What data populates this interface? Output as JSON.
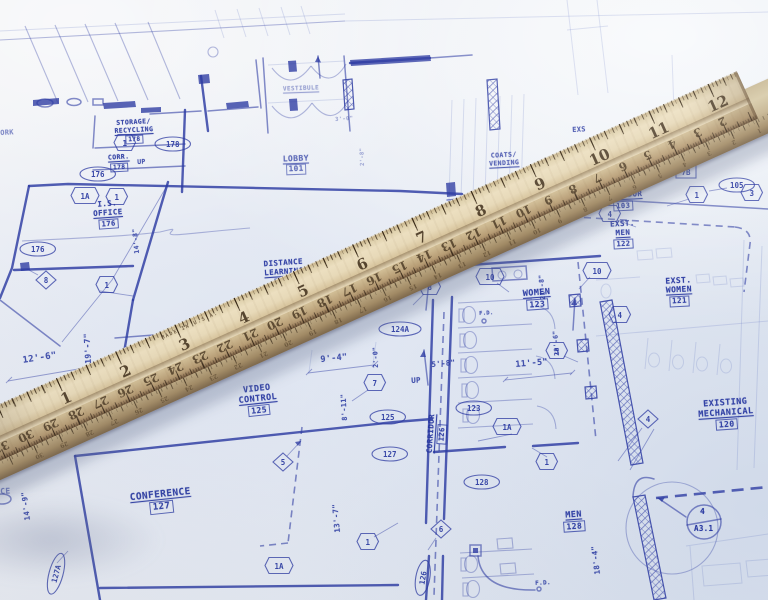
{
  "colors": {
    "ink": "#2c3aa2",
    "label_ink": "#2636a0",
    "paper": "#e9edf4",
    "wood_light": "#ecdfc0",
    "wood_dark": "#957858"
  },
  "ruler": {
    "made_in": "MADE IN U.S.A.",
    "inch_labels": [
      "1",
      "2",
      "3",
      "4",
      "5",
      "6",
      "7",
      "8",
      "9",
      "10",
      "11",
      "12"
    ],
    "cm_min": 1,
    "cm_max": 31,
    "ruler2_cm_min": 1,
    "ruler2_cm_max": 30
  },
  "blueprint": {
    "rooms": [
      {
        "lines": [
          "STORAGE/",
          "RECYCLING"
        ],
        "num": "178",
        "x": 103,
        "y": 119,
        "w": 62,
        "fs": 6.5,
        "rot": -3
      },
      {
        "lines": [
          "CORR."
        ],
        "num": "178",
        "x": 100,
        "y": 154,
        "w": 38,
        "fs": 6.5,
        "rot": -3
      },
      {
        "lines": [
          "I.S.",
          "OFFICE"
        ],
        "num": "176",
        "x": 82,
        "y": 200,
        "w": 52,
        "fs": 7.5,
        "rot": -4
      },
      {
        "lines": [
          "VESTIBULE"
        ],
        "num": "",
        "x": 270,
        "y": 85,
        "w": 62,
        "fs": 6,
        "rot": -2,
        "op": 0.42
      },
      {
        "lines": [
          "LOBBY"
        ],
        "num": "101",
        "x": 272,
        "y": 154,
        "w": 48,
        "fs": 8,
        "rot": -2,
        "op": 0.7
      },
      {
        "lines": [
          "DISTANCE",
          "LEARNING"
        ],
        "num": "124",
        "x": 247,
        "y": 259,
        "w": 74,
        "fs": 7.5,
        "rot": -4
      },
      {
        "lines": [
          "COATS/",
          "VENDING"
        ],
        "num": "",
        "x": 482,
        "y": 152,
        "w": 44,
        "fs": 6.5,
        "rot": -3,
        "op": 0.8
      },
      {
        "lines": [
          "VIDEO",
          "CONTROL"
        ],
        "num": "125",
        "x": 225,
        "y": 384,
        "w": 66,
        "fs": 8.5,
        "rot": -6
      },
      {
        "lines": [
          "CONFERENCE"
        ],
        "num": "127",
        "x": 112,
        "y": 489,
        "w": 98,
        "fs": 9.5,
        "rot": -6
      },
      {
        "lines": [
          "WOMEN"
        ],
        "num": "123",
        "x": 508,
        "y": 288,
        "w": 58,
        "fs": 8.5,
        "rot": -4
      },
      {
        "lines": [
          "MEN"
        ],
        "num": "128",
        "x": 550,
        "y": 510,
        "w": 48,
        "fs": 8.5,
        "rot": -4
      },
      {
        "lines": [
          "CORRIDOR"
        ],
        "num": "126",
        "x": 406,
        "y": 424,
        "w": 62,
        "fs": 7.5,
        "rot": -86
      },
      {
        "lines": [
          "CORRIDOR"
        ],
        "num": "103",
        "x": 592,
        "y": 191,
        "w": 62,
        "fs": 7.5,
        "rot": -3
      },
      {
        "lines": [
          "EXST.",
          "MEN"
        ],
        "num": "122",
        "x": 600,
        "y": 220,
        "w": 46,
        "fs": 7.5,
        "rot": -3
      },
      {
        "lines": [
          "EXST.",
          "WOMEN"
        ],
        "num": "121",
        "x": 648,
        "y": 276,
        "w": 62,
        "fs": 8,
        "rot": -3
      },
      {
        "lines": [
          "EXISTING",
          "MECHANICAL"
        ],
        "num": "120",
        "x": 684,
        "y": 398,
        "w": 84,
        "fs": 8.5,
        "rot": -4
      }
    ],
    "dims": [
      {
        "t": "12'-6\"",
        "x": 22,
        "y": 356,
        "rot": -9,
        "fs": 9
      },
      {
        "t": "19'-7\"",
        "x": 84,
        "y": 364,
        "rot": -93,
        "fs": 8
      },
      {
        "t": "14'-8\"",
        "x": 133,
        "y": 254,
        "rot": -95,
        "fs": 6.5
      },
      {
        "t": "14'-9\"",
        "x": 23,
        "y": 521,
        "rot": -97,
        "fs": 7.5
      },
      {
        "t": "9'-4\"",
        "x": 320,
        "y": 355,
        "rot": -6,
        "fs": 8.5
      },
      {
        "t": "2'-0\"",
        "x": 372,
        "y": 368,
        "rot": -92,
        "fs": 6.5
      },
      {
        "t": "8'-11\"",
        "x": 341,
        "y": 421,
        "rot": -93,
        "fs": 7
      },
      {
        "t": "13'-7\"",
        "x": 333,
        "y": 533,
        "rot": -95,
        "fs": 7.5
      },
      {
        "t": "5'-8\"",
        "x": 431,
        "y": 360,
        "rot": -5,
        "fs": 7.5
      },
      {
        "t": "11'-5\"",
        "x": 515,
        "y": 360,
        "rot": -5,
        "fs": 8.5
      },
      {
        "t": "21'-8\"",
        "x": 539,
        "y": 300,
        "rot": -94,
        "fs": 6.5
      },
      {
        "t": "22'-6\"",
        "x": 553,
        "y": 356,
        "rot": -94,
        "fs": 6.5
      },
      {
        "t": "18'-4\"",
        "x": 593,
        "y": 575,
        "rot": -97,
        "fs": 7.5
      },
      {
        "t": "3'-0\"",
        "x": 335,
        "y": 117,
        "rot": -4,
        "fs": 5.5,
        "op": 0.4
      },
      {
        "t": "2'-8\"",
        "x": 360,
        "y": 166,
        "rot": -92,
        "fs": 5.5,
        "op": 0.4
      }
    ],
    "texts": [
      {
        "t": "UP",
        "x": 137,
        "y": 158,
        "fs": 6.5
      },
      {
        "t": "UP",
        "x": 411,
        "y": 376,
        "fs": 7.5
      },
      {
        "t": "F.D.",
        "x": 479,
        "y": 311,
        "fs": 5.5
      },
      {
        "t": "F.D.",
        "x": 535,
        "y": 580,
        "fs": 6
      },
      {
        "t": "EXS",
        "x": 572,
        "y": 126,
        "fs": 7
      },
      {
        "t": "ORK",
        "x": 0,
        "y": 129,
        "fs": 7,
        "op": 0.55
      },
      {
        "t": "CE",
        "x": 0,
        "y": 487,
        "fs": 8,
        "op": 0.6
      }
    ],
    "tags": [
      {
        "s": "hex",
        "t": "1",
        "x": 125,
        "y": 144
      },
      {
        "s": "hex",
        "t": "1A",
        "x": 85,
        "y": 197
      },
      {
        "s": "hex",
        "t": "1",
        "x": 117,
        "y": 198
      },
      {
        "s": "hex",
        "t": "1",
        "x": 107,
        "y": 286
      },
      {
        "s": "hex",
        "t": "7",
        "x": 375,
        "y": 384
      },
      {
        "s": "hex",
        "t": "8",
        "x": 430,
        "y": 288
      },
      {
        "s": "hex",
        "t": "10",
        "x": 490,
        "y": 278
      },
      {
        "s": "hex",
        "t": "10",
        "x": 597,
        "y": 272
      },
      {
        "s": "hex",
        "t": "5",
        "x": 557,
        "y": 352
      },
      {
        "s": "hex",
        "t": "4",
        "x": 610,
        "y": 215
      },
      {
        "s": "hex",
        "t": "1",
        "x": 697,
        "y": 196
      },
      {
        "s": "hex",
        "t": "3",
        "x": 752,
        "y": 194
      },
      {
        "s": "hex",
        "t": "4",
        "x": 620,
        "y": 316
      },
      {
        "s": "hex",
        "t": "1A",
        "x": 507,
        "y": 428
      },
      {
        "s": "hex",
        "t": "1",
        "x": 547,
        "y": 463
      },
      {
        "s": "hex",
        "t": "1A",
        "x": 279,
        "y": 567
      },
      {
        "s": "hex",
        "t": "1",
        "x": 368,
        "y": 543
      },
      {
        "s": "dia",
        "t": "8",
        "x": 46,
        "y": 281
      },
      {
        "s": "dia",
        "t": "5",
        "x": 283,
        "y": 463
      },
      {
        "s": "dia",
        "t": "6",
        "x": 441,
        "y": 530
      },
      {
        "s": "dia",
        "t": "4",
        "x": 648,
        "y": 420
      },
      {
        "s": "oval",
        "t": "176",
        "x": 98,
        "y": 175
      },
      {
        "s": "oval",
        "t": "176",
        "x": 38,
        "y": 250
      },
      {
        "s": "oval",
        "t": "178",
        "x": 173,
        "y": 145
      },
      {
        "s": "oval",
        "t": "124A",
        "x": 400,
        "y": 330
      },
      {
        "s": "oval",
        "t": "125",
        "x": 388,
        "y": 418
      },
      {
        "s": "oval",
        "t": "127",
        "x": 390,
        "y": 455
      },
      {
        "s": "oval",
        "t": "123",
        "x": 474,
        "y": 409
      },
      {
        "s": "oval",
        "t": "128",
        "x": 482,
        "y": 483
      },
      {
        "s": "oval",
        "t": "126",
        "x": 424,
        "y": 578,
        "rot": -80
      },
      {
        "s": "oval",
        "t": "127A",
        "x": 57,
        "y": 574,
        "rot": -75
      },
      {
        "s": "oval",
        "t": "105",
        "x": 737,
        "y": 186
      },
      {
        "s": "box",
        "t": "7B",
        "x": 686,
        "y": 173
      }
    ],
    "detail_marker": {
      "top": "4",
      "bottom": "A3.1",
      "x": 704,
      "y": 522
    }
  }
}
